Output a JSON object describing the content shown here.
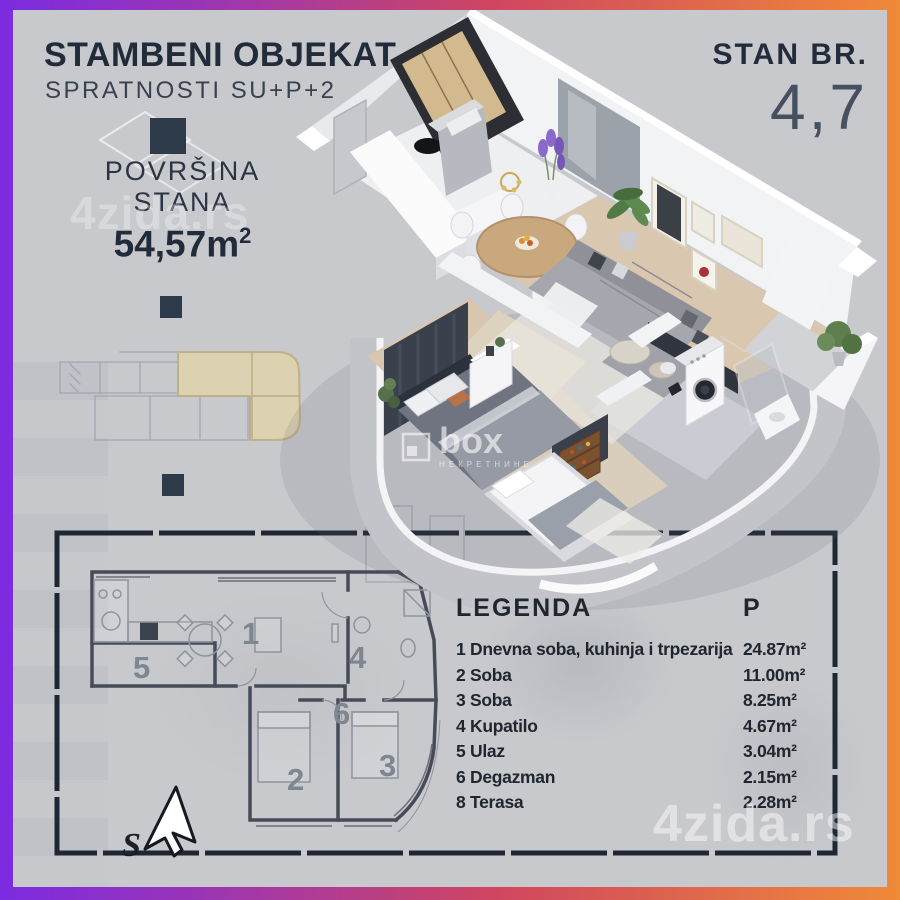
{
  "page": {
    "type": "real-estate apartment floor plan flyer"
  },
  "header": {
    "title": "STAMBENI OBJEKAT",
    "subtitle": "SPRATNOSTI SU+P+2"
  },
  "area": {
    "label_line1": "POVRŠINA",
    "label_line2": "STANA",
    "value": "54,57m",
    "sup": "2"
  },
  "unit": {
    "label": "STAN BR.",
    "number": "4,7"
  },
  "legend": {
    "title": "LEGENDA",
    "area_column": "P",
    "rows": [
      {
        "num": "1",
        "name": "1 Dnevna soba, kuhinja i trpezarija",
        "area": "24.87m²"
      },
      {
        "num": "2",
        "name": "2 Soba",
        "area": "11.00m²"
      },
      {
        "num": "3",
        "name": "3 Soba",
        "area": "8.25m²"
      },
      {
        "num": "4",
        "name": "4 Kupatilo",
        "area": "4.67m²"
      },
      {
        "num": "5",
        "name": "5 Ulaz",
        "area": "3.04m²"
      },
      {
        "num": "6",
        "name": "6 Degazman",
        "area": "2.15m²"
      },
      {
        "num": "8",
        "name": "8 Terasa",
        "area": "2.28m²"
      }
    ]
  },
  "plan2d": {
    "rooms": [
      "1",
      "2",
      "3",
      "4",
      "5",
      "6"
    ],
    "compass": "S"
  },
  "watermarks": {
    "brand": "4zida.rs",
    "brand2": "4zida.rs",
    "agency": "box",
    "agency_sub": "НЕКРЕТНИНЕ"
  },
  "colors": {
    "border_left": "#7b2be0",
    "border_mid": "#cf4660",
    "border_right": "#ef8a38",
    "background": "#c8c9cd",
    "ink": "#232c3a",
    "frame": "#1e2733",
    "site_highlight": "#ded2ac",
    "wood_floor": "#d9c7b0",
    "sofa": "#a6a7ae",
    "accent_wall": "#3a414d"
  }
}
